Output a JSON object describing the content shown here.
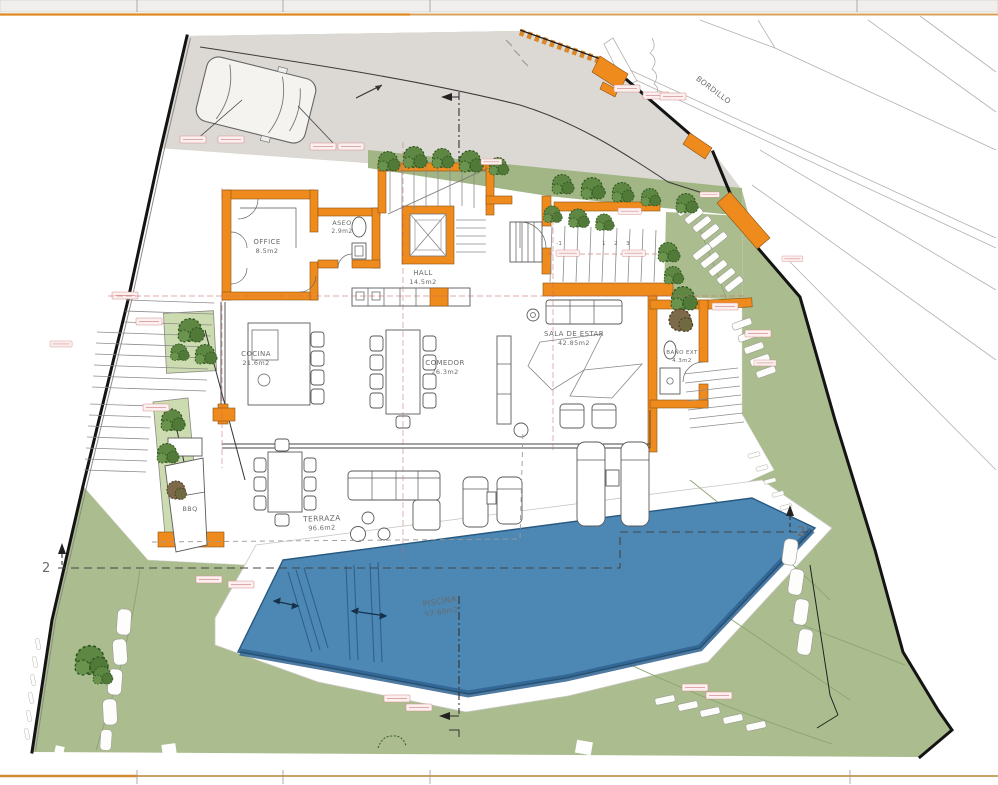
{
  "plan": {
    "rooms": [
      {
        "name": "OFFICE",
        "area": "8.5m2"
      },
      {
        "name": "ASEO",
        "area": "2.9m2"
      },
      {
        "name": "HALL",
        "area": "14.5m2"
      },
      {
        "name": "COCINA",
        "area": "21.6m2"
      },
      {
        "name": "COMEDOR",
        "area": "26.3m2"
      },
      {
        "name": "SALA DE ESTAR",
        "area": "42.85m2"
      },
      {
        "name": "BAÑO EXT",
        "area": "4.3m2"
      },
      {
        "name": "TERRAZA",
        "area": "96.6m2"
      },
      {
        "name": "PISCINA",
        "area": "57.60m2"
      },
      {
        "name": "BBQ",
        "area": ""
      }
    ],
    "site_labels": {
      "curb": "BORDILLO"
    },
    "section_markers": {
      "left": "2",
      "right": "2'"
    },
    "stair_steps": [
      "-1",
      "1",
      "2",
      "3"
    ],
    "colors": {
      "wall_orange": "#ef8b1d",
      "garden_green": "#abbd8e",
      "planter_green": "#cddbb0",
      "pool_blue": "#4d87b3",
      "road_grey": "#dcd9d4",
      "dimension_red": "#d49090",
      "frame_orange": "#e0861f"
    }
  }
}
